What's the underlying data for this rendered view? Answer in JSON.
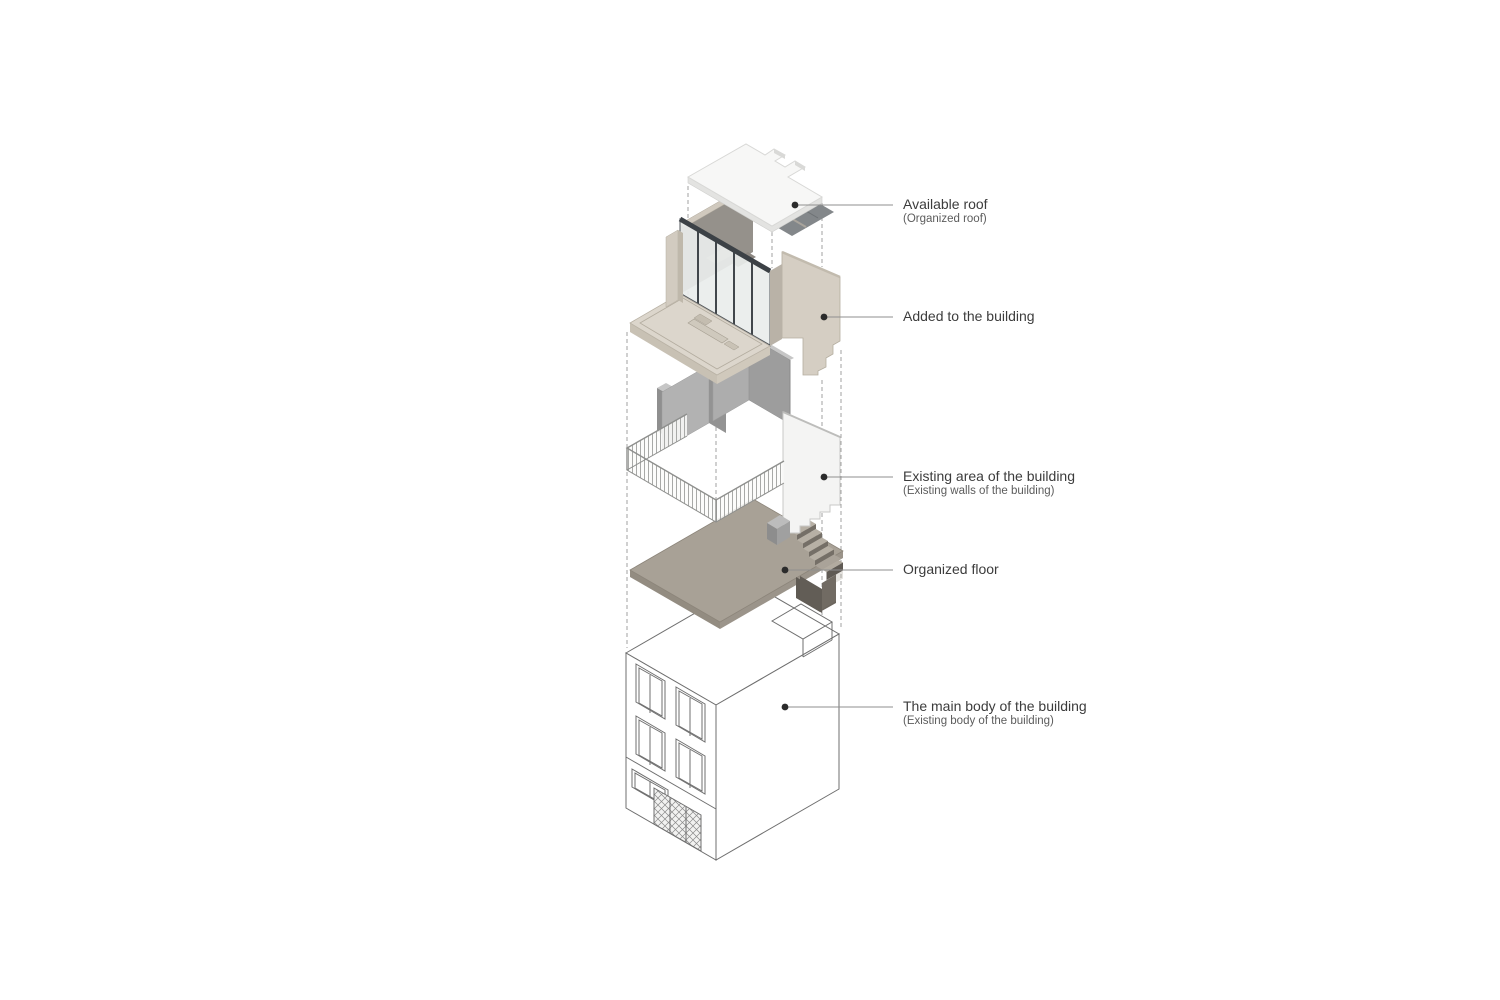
{
  "figure": {
    "type": "exploded-axonometric-architecture-diagram",
    "background": "#ffffff"
  },
  "labels": [
    {
      "id": "available-roof",
      "title": "Available roof",
      "subtitle": "(Organized roof)"
    },
    {
      "id": "added-volume",
      "title": "Added to the building",
      "subtitle": ""
    },
    {
      "id": "existing-area",
      "title": "Existing area of the building",
      "subtitle": "(Existing walls of the building)"
    },
    {
      "id": "organized-floor",
      "title": "Organized floor",
      "subtitle": ""
    },
    {
      "id": "main-body",
      "title": "The main body of the building",
      "subtitle": "(Existing body of the building)"
    }
  ],
  "layers": [
    {
      "name": "roof-plate",
      "description": "white flat roof slab with notched edge"
    },
    {
      "name": "rooftop-addition",
      "description": "beige volume with glass facade and terrace"
    },
    {
      "name": "existing-walls",
      "description": "gray existing walls with perimeter railing and white party wall"
    },
    {
      "name": "floor-plate",
      "description": "taupe organized floor slab with staircase"
    },
    {
      "name": "building-body",
      "description": "wireframe three-storey building with windows and lattice door"
    }
  ],
  "colors": {
    "roof_white": "#f7f7f6",
    "beige_wall": "#d5cec3",
    "beige_floor": "#dcd6cc",
    "glass_frame": "#41464b",
    "glass_pane": "#e9edec",
    "gray_wall": "#b2b2b2",
    "gray_wall_dark": "#919191",
    "taupe_floor": "#a8a196",
    "stair_dark": "#5f5a53",
    "wire_line": "#6f6f6f",
    "leader_line": "#8f8f8f",
    "dot": "#2b2b2b",
    "text_primary": "#3c3c3c",
    "text_secondary": "#5c5c5c"
  }
}
